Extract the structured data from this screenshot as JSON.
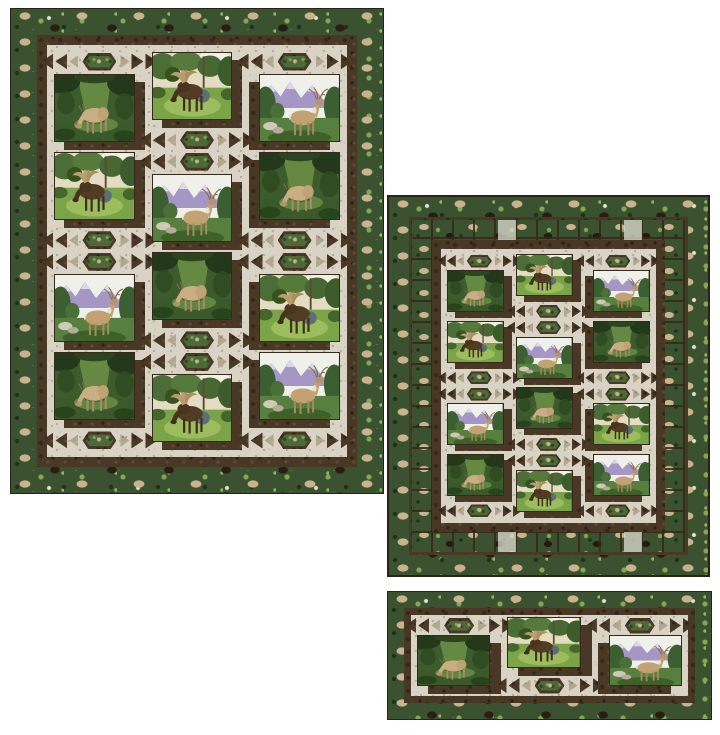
{
  "page": {
    "background": "#ffffff",
    "width": 720,
    "height": 735
  },
  "palette": {
    "fabric_green_base": "#3a5230",
    "fabric_green_dark": "#1d3117",
    "fabric_green_light": "#83a854",
    "fabric_animal_tan": "#c9b28c",
    "fabric_cream_base": "#d9d3c5",
    "fabric_cream_speckle": "#b5ae9e",
    "fabric_brown_base": "#4a3826",
    "fabric_brown_dark": "#342717",
    "fabric_taupe_base": "#b2a68d",
    "binding_brown": "#2b2115",
    "panel_outline": "#35291b",
    "hex_center_green": "#4c6a38",
    "moose_body": "#523c23",
    "deer_body": "#c2a172",
    "mountain_lavender": "#a596c6",
    "meadow_green": "#7ba449"
  },
  "scenes": {
    "elk": {
      "label": "elk-grazing-in-forest"
    },
    "moose": {
      "label": "bull-moose-in-meadow"
    },
    "buck": {
      "label": "whitetail-buck-with-mountains"
    }
  },
  "arrow_motif": {
    "left_triangles": [
      "dark",
      "dark",
      "taupe"
    ],
    "center": "hexagon-medallion",
    "right_triangles": [
      "taupe",
      "dark",
      "dark"
    ]
  },
  "quilts": [
    {
      "id": "quilt-large",
      "label": "large-bed-quilt",
      "size": "l",
      "pos": {
        "left": 10,
        "top": 8,
        "width": 374,
        "height": 486
      },
      "borders": [
        {
          "type": "binding",
          "width": 1
        },
        {
          "type": "green-print",
          "width": 26
        },
        {
          "type": "inner-brown",
          "width": 10
        }
      ],
      "shadow_sides": [
        "right",
        "right",
        "left"
      ],
      "columns": [
        [
          "arrow",
          "elk",
          "moose",
          "arrow",
          "arrow",
          "buck",
          "elk",
          "arrow"
        ],
        [
          "moose",
          "arrow",
          "arrow",
          "buck",
          "elk",
          "arrow",
          "arrow",
          "moose"
        ],
        [
          "arrow",
          "buck",
          "elk",
          "arrow",
          "arrow",
          "moose",
          "buck",
          "arrow"
        ]
      ]
    },
    {
      "id": "quilt-lap",
      "label": "lap-quilt",
      "size": "m",
      "pos": {
        "left": 387,
        "top": 195,
        "width": 323,
        "height": 382
      },
      "borders": [
        {
          "type": "binding",
          "width": 2
        },
        {
          "type": "green-print",
          "width": 20
        },
        {
          "type": "line-brown",
          "width": 3
        },
        {
          "type": "pieced-squares",
          "width": 20
        },
        {
          "type": "inner-brown",
          "width": 9
        }
      ],
      "shadow_sides": [
        "right",
        "right",
        "left"
      ],
      "columns": [
        [
          "arrow",
          "elk",
          "moose",
          "arrow",
          "arrow",
          "buck",
          "elk",
          "arrow"
        ],
        [
          "moose",
          "arrow",
          "arrow",
          "buck",
          "elk",
          "arrow",
          "arrow",
          "moose"
        ],
        [
          "arrow",
          "buck",
          "elk",
          "arrow",
          "arrow",
          "moose",
          "buck",
          "arrow"
        ]
      ]
    },
    {
      "id": "quilt-runner",
      "label": "table-runner",
      "size": "s",
      "pos": {
        "left": 387,
        "top": 591,
        "width": 325,
        "height": 129
      },
      "borders": [
        {
          "type": "binding",
          "width": 1
        },
        {
          "type": "green-print",
          "width": 16
        },
        {
          "type": "inner-brown",
          "width": 7
        }
      ],
      "shadow_sides": [
        "right",
        "right",
        "left"
      ],
      "columns": [
        [
          "arrow",
          "elk"
        ],
        [
          "moose",
          "arrow"
        ],
        [
          "arrow",
          "buck"
        ]
      ]
    }
  ]
}
